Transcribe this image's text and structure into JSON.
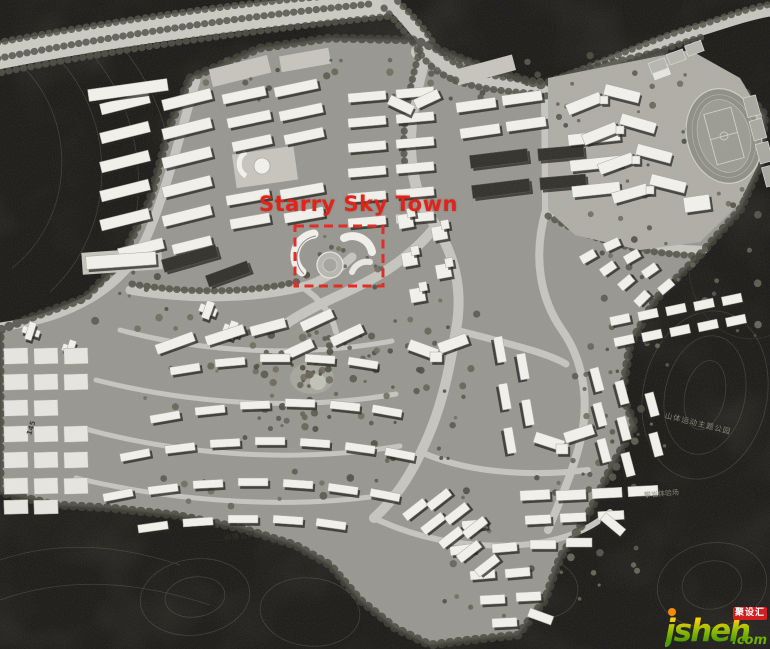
{
  "annotation": {
    "label": "Starry Sky Town",
    "color": "#e2231a",
    "box": {
      "x": 295,
      "y": 226,
      "w": 88,
      "h": 60
    }
  },
  "map_labels": [
    {
      "id": "road-145",
      "text": "145"
    },
    {
      "id": "mountain-park",
      "text": "山体公园"
    },
    {
      "id": "mountain-sports-theme-park",
      "text": "山体运动主题公园"
    },
    {
      "id": "climbing-experience-field",
      "text": "攀岩体验场"
    }
  ],
  "watermark": {
    "brand": "jsheh",
    "tld": ".com",
    "badge": "聚设汇",
    "colors": {
      "gradient_top": "#ffd000",
      "gradient_mid": "#9ebf00",
      "gradient_bottom": "#4f9d00",
      "dot": "#f08c00",
      "badge_bg": "#cf1f1f",
      "badge_text": "#ffffff",
      "tld_color": "#6fae00"
    }
  },
  "palette": {
    "terrain": "#35332e",
    "ground": "#96958e",
    "road": "#c6c5be",
    "building": "#f4f3ee",
    "building_dark": "#2d2c27",
    "pad": "#c6c5bd",
    "shadow": "#1c1b17",
    "tree": "#55544a",
    "accent_red": "#e2231a"
  }
}
